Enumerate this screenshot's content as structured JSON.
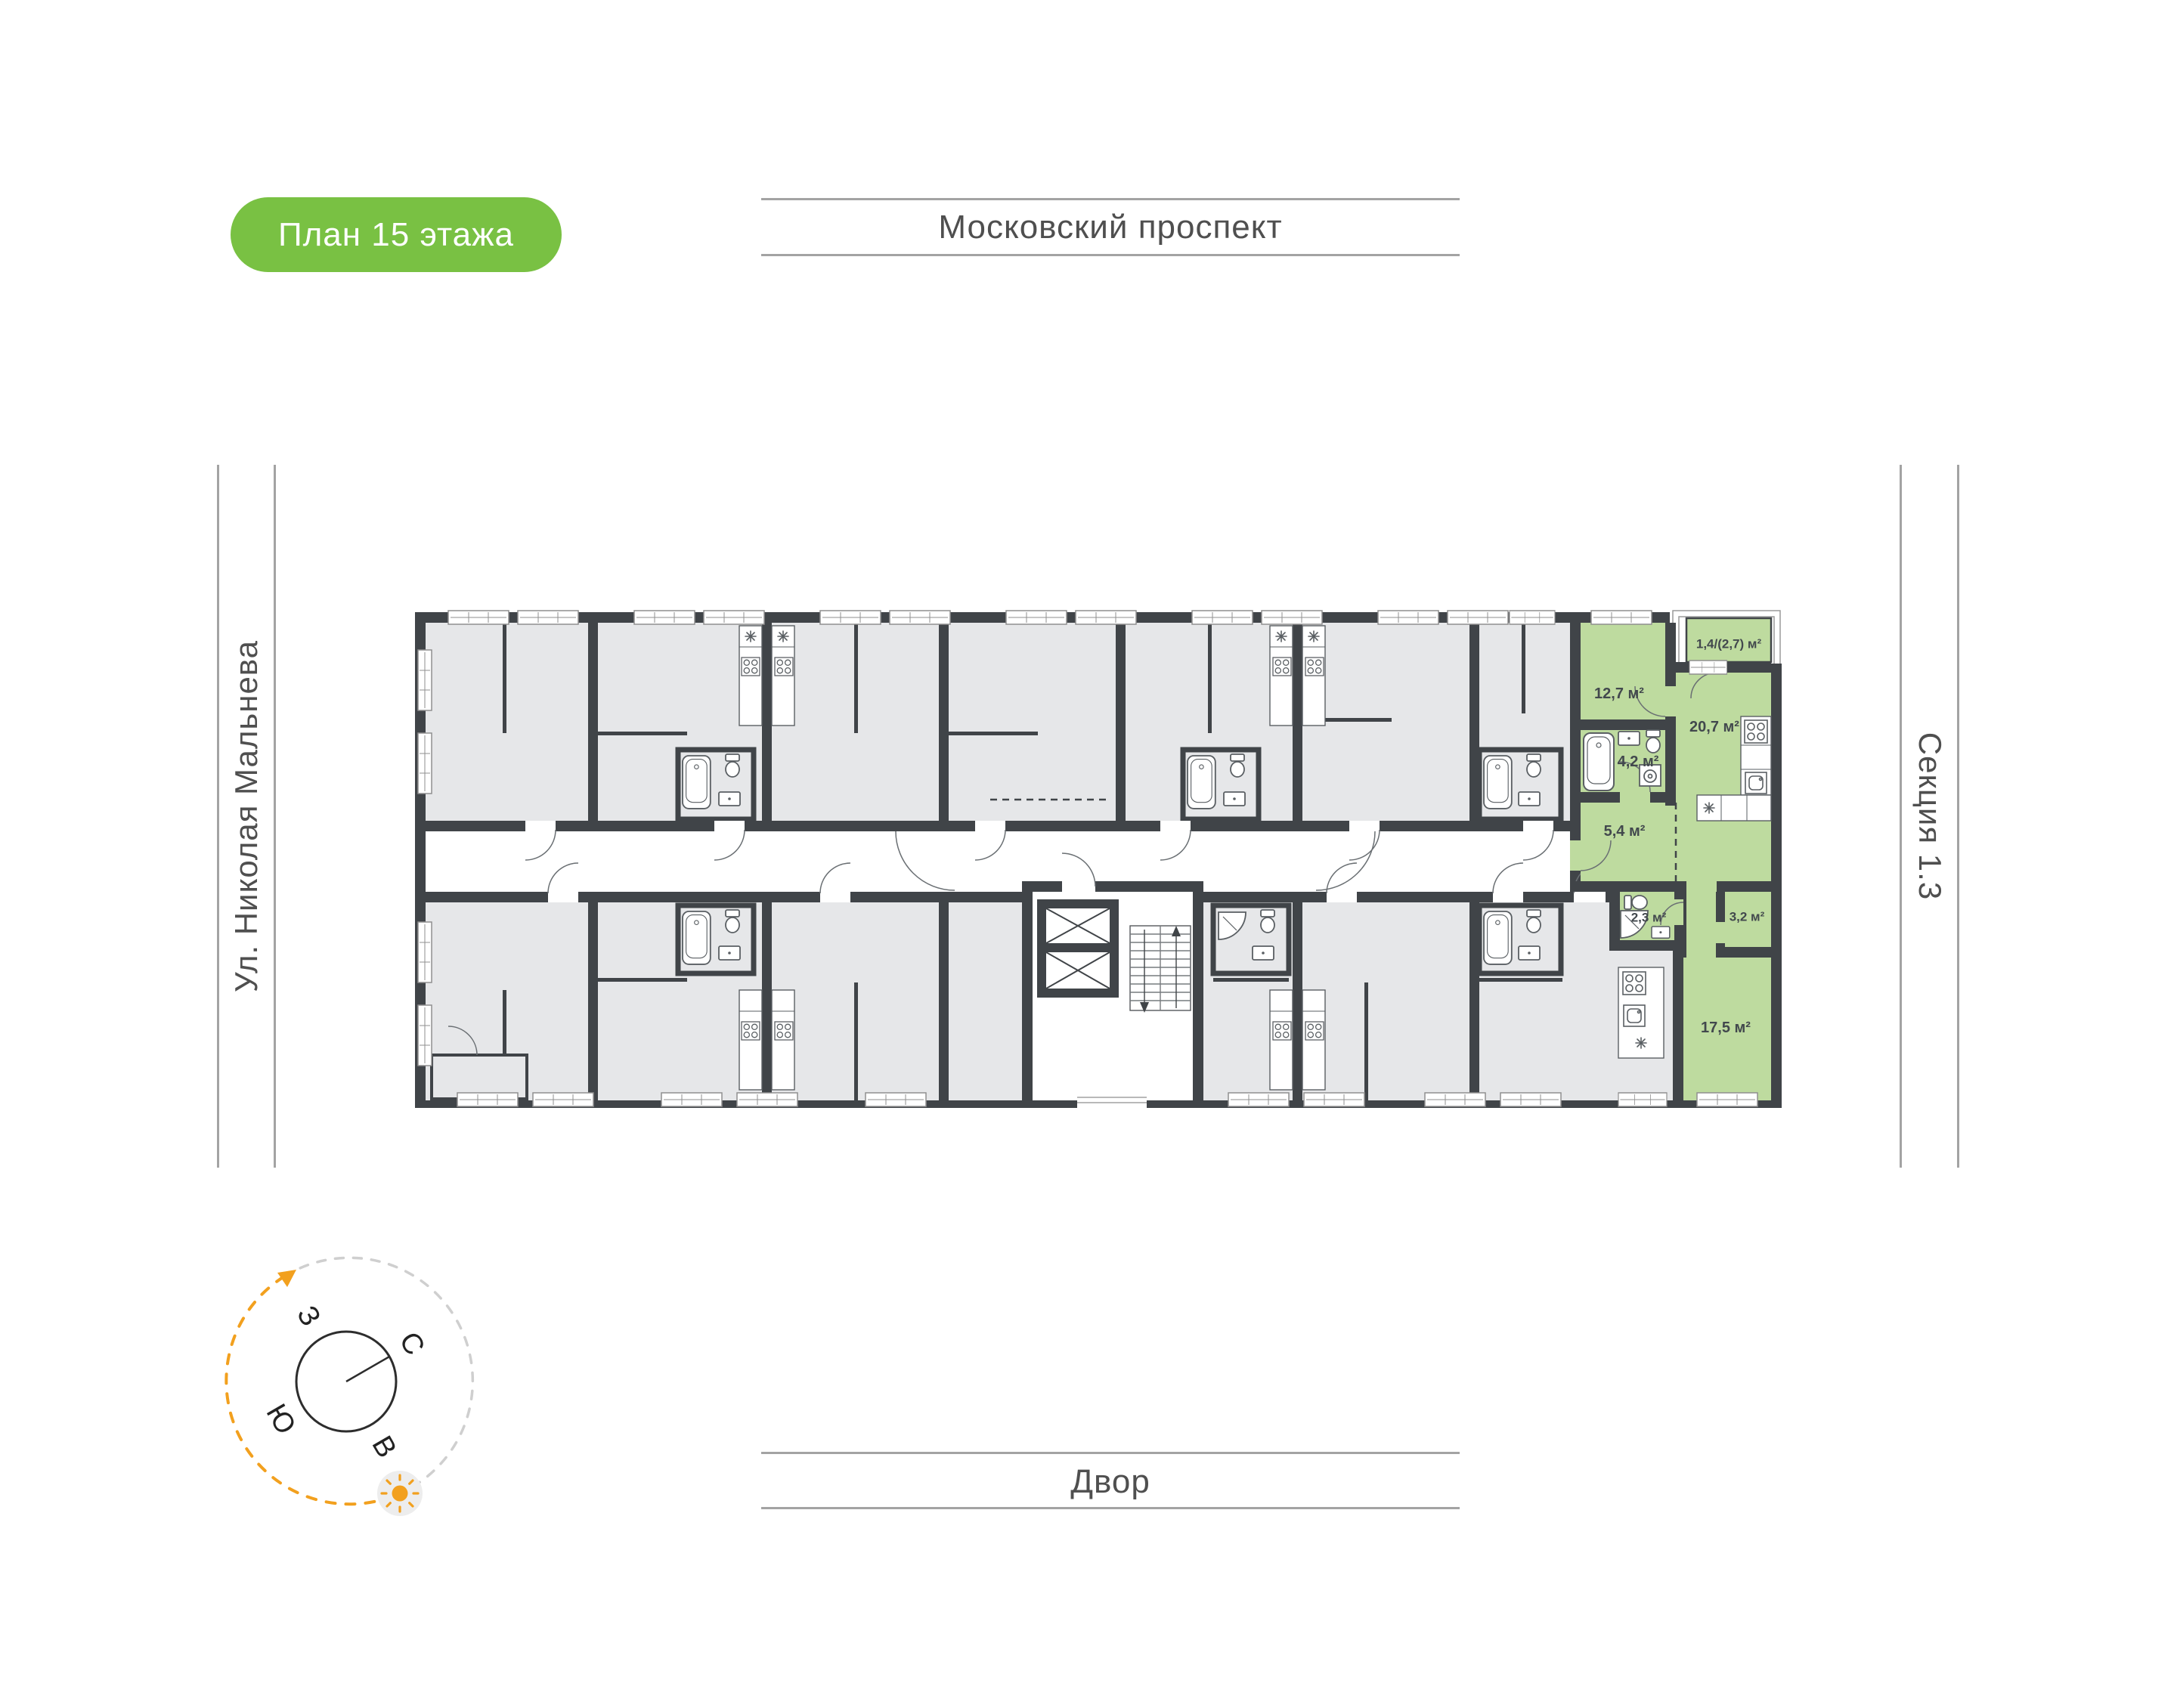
{
  "badge": {
    "label": "План 15 этажа"
  },
  "surroundings": {
    "top": "Московский проспект",
    "left": "Ул. Николая Мальнева",
    "right": "Секция 1.3",
    "bottom": "Двор"
  },
  "compass": {
    "north": "С",
    "south": "Ю",
    "west": "З",
    "east": "В"
  },
  "apartment": {
    "status": "highlighted",
    "rooms": [
      {
        "name": "balcony",
        "area": "1,4/(2,7) м²"
      },
      {
        "name": "bedroom",
        "area": "12,7 м²"
      },
      {
        "name": "kitchen-living",
        "area": "20,7 м²"
      },
      {
        "name": "bathroom",
        "area": "4,2 м²"
      },
      {
        "name": "hallway",
        "area": "5,4 м²"
      },
      {
        "name": "wc",
        "area": "2,3 м²"
      },
      {
        "name": "storage",
        "area": "3,2 м²"
      },
      {
        "name": "living-room",
        "area": "17,5 м²"
      }
    ]
  },
  "colors": {
    "badge_green": "#79c143",
    "apartment_green": "#bedb9f",
    "wall_dark": "#404448",
    "room_gray": "#e6e7e9",
    "compass_orange": "#f2a01e"
  }
}
